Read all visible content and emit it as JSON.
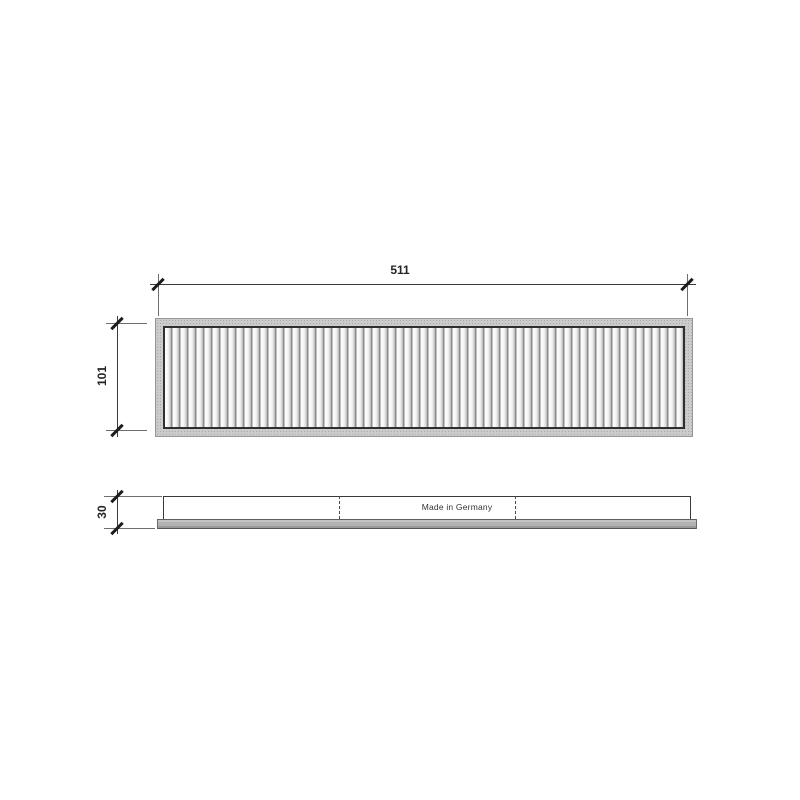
{
  "dimensions": {
    "width": "511",
    "height": "101",
    "depth": "30"
  },
  "marking": "Made in Germany",
  "colors": {
    "background": "#ffffff",
    "outline": "#3a3a3a",
    "frame_fill": "#cbcbcb",
    "frame_inner_border": "#2f2f2f",
    "pleat_line": "#7d7d7d",
    "side_bar_fill": "#b2b2b2",
    "tick": "#1c1c1c"
  }
}
